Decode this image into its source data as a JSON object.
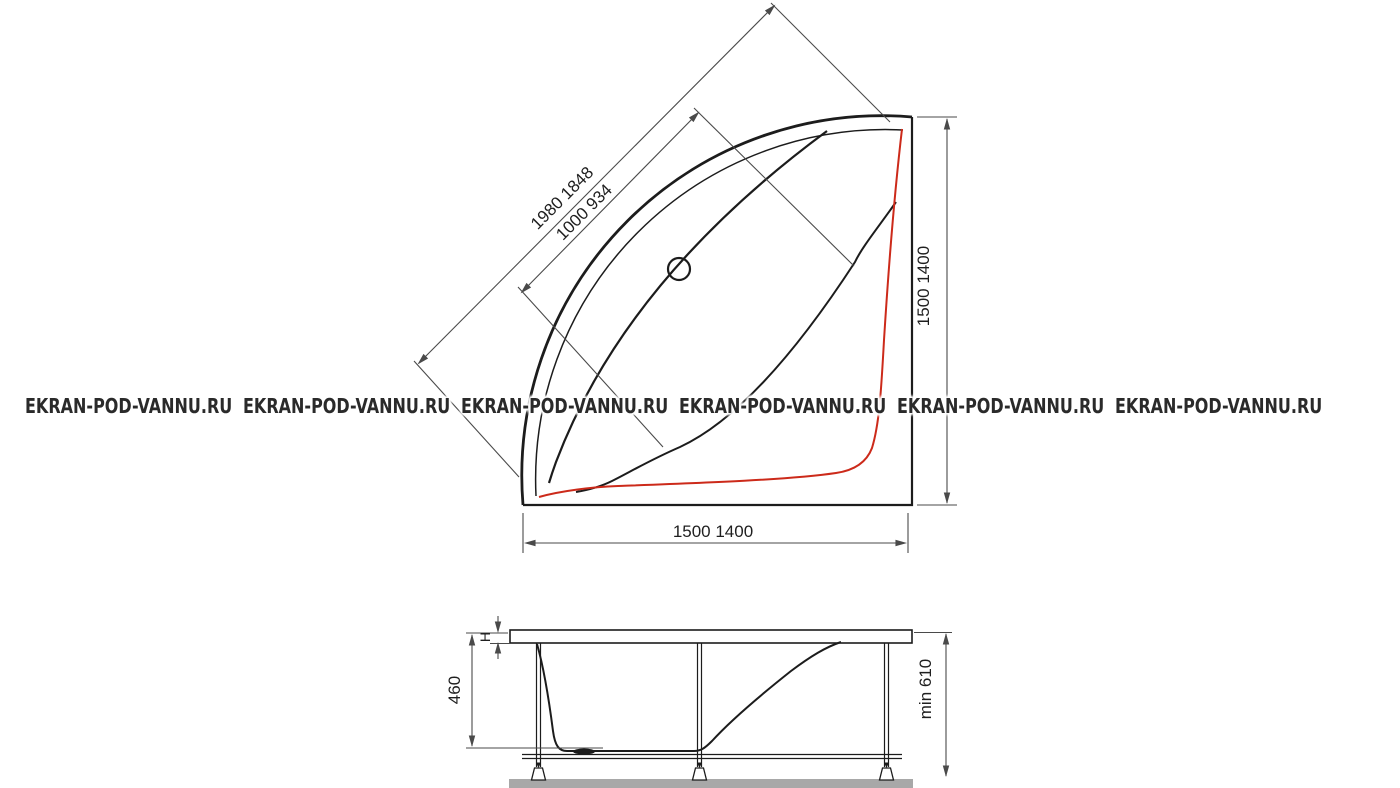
{
  "watermark": {
    "text": "EKRAN-POD-VANNU.RU"
  },
  "plan_view": {
    "dims": {
      "diagonal_outer": "1980 1848",
      "diagonal_inner": "1000 934",
      "side_right": "1500 1400",
      "side_bottom": "1500 1400"
    }
  },
  "side_view": {
    "dims": {
      "rim_height": "H",
      "basin_depth": "460",
      "installation_height": "min 610"
    }
  },
  "colors": {
    "line": "#1c1c1c",
    "dimension": "#4a4a4a",
    "accent": "#cc2a1a",
    "floor": "#a8a8a8",
    "watermark": "#2a2a2a"
  }
}
